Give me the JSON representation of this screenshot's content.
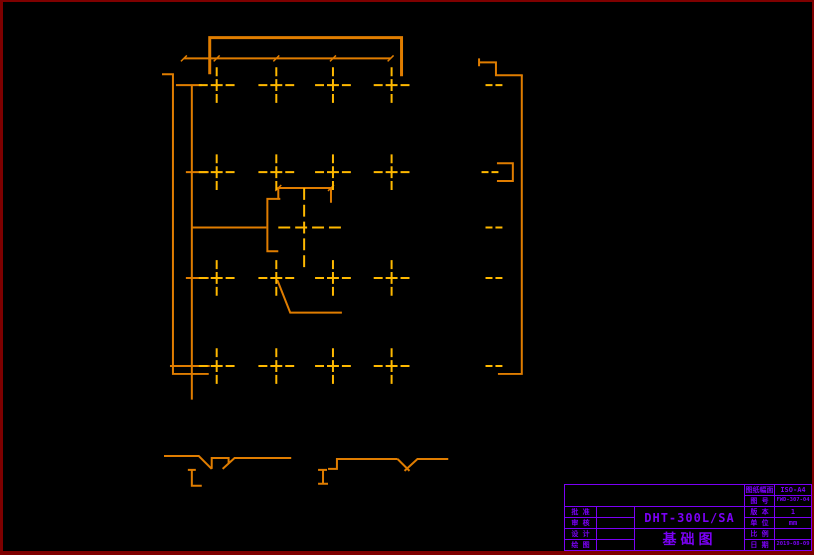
{
  "window": {
    "background": "#000000",
    "border_color": "#7E0000"
  },
  "drawing": {
    "kind": "cad-foundation-plan",
    "outline_color": "#E07D00",
    "centerline_color": "#FFB900"
  },
  "title_block": {
    "color": "#7B00F5",
    "model_number": "DHT-300L/SA",
    "drawing_title": "基础图",
    "left_rows": [
      {
        "label": "批 准",
        "value": ""
      },
      {
        "label": "审 核",
        "value": ""
      },
      {
        "label": "设 计",
        "value": ""
      },
      {
        "label": "绘 图",
        "value": ""
      }
    ],
    "right_rows": [
      {
        "label": "图纸幅面",
        "value": "ISO-A4"
      },
      {
        "label": "图 号",
        "value": "FWD-307-04"
      },
      {
        "label": "版 本",
        "value": "1"
      },
      {
        "label": "单 位",
        "value": "mm"
      },
      {
        "label": "比 例",
        "value": ""
      },
      {
        "label": "日 期",
        "value": "2019-08-09"
      }
    ]
  }
}
